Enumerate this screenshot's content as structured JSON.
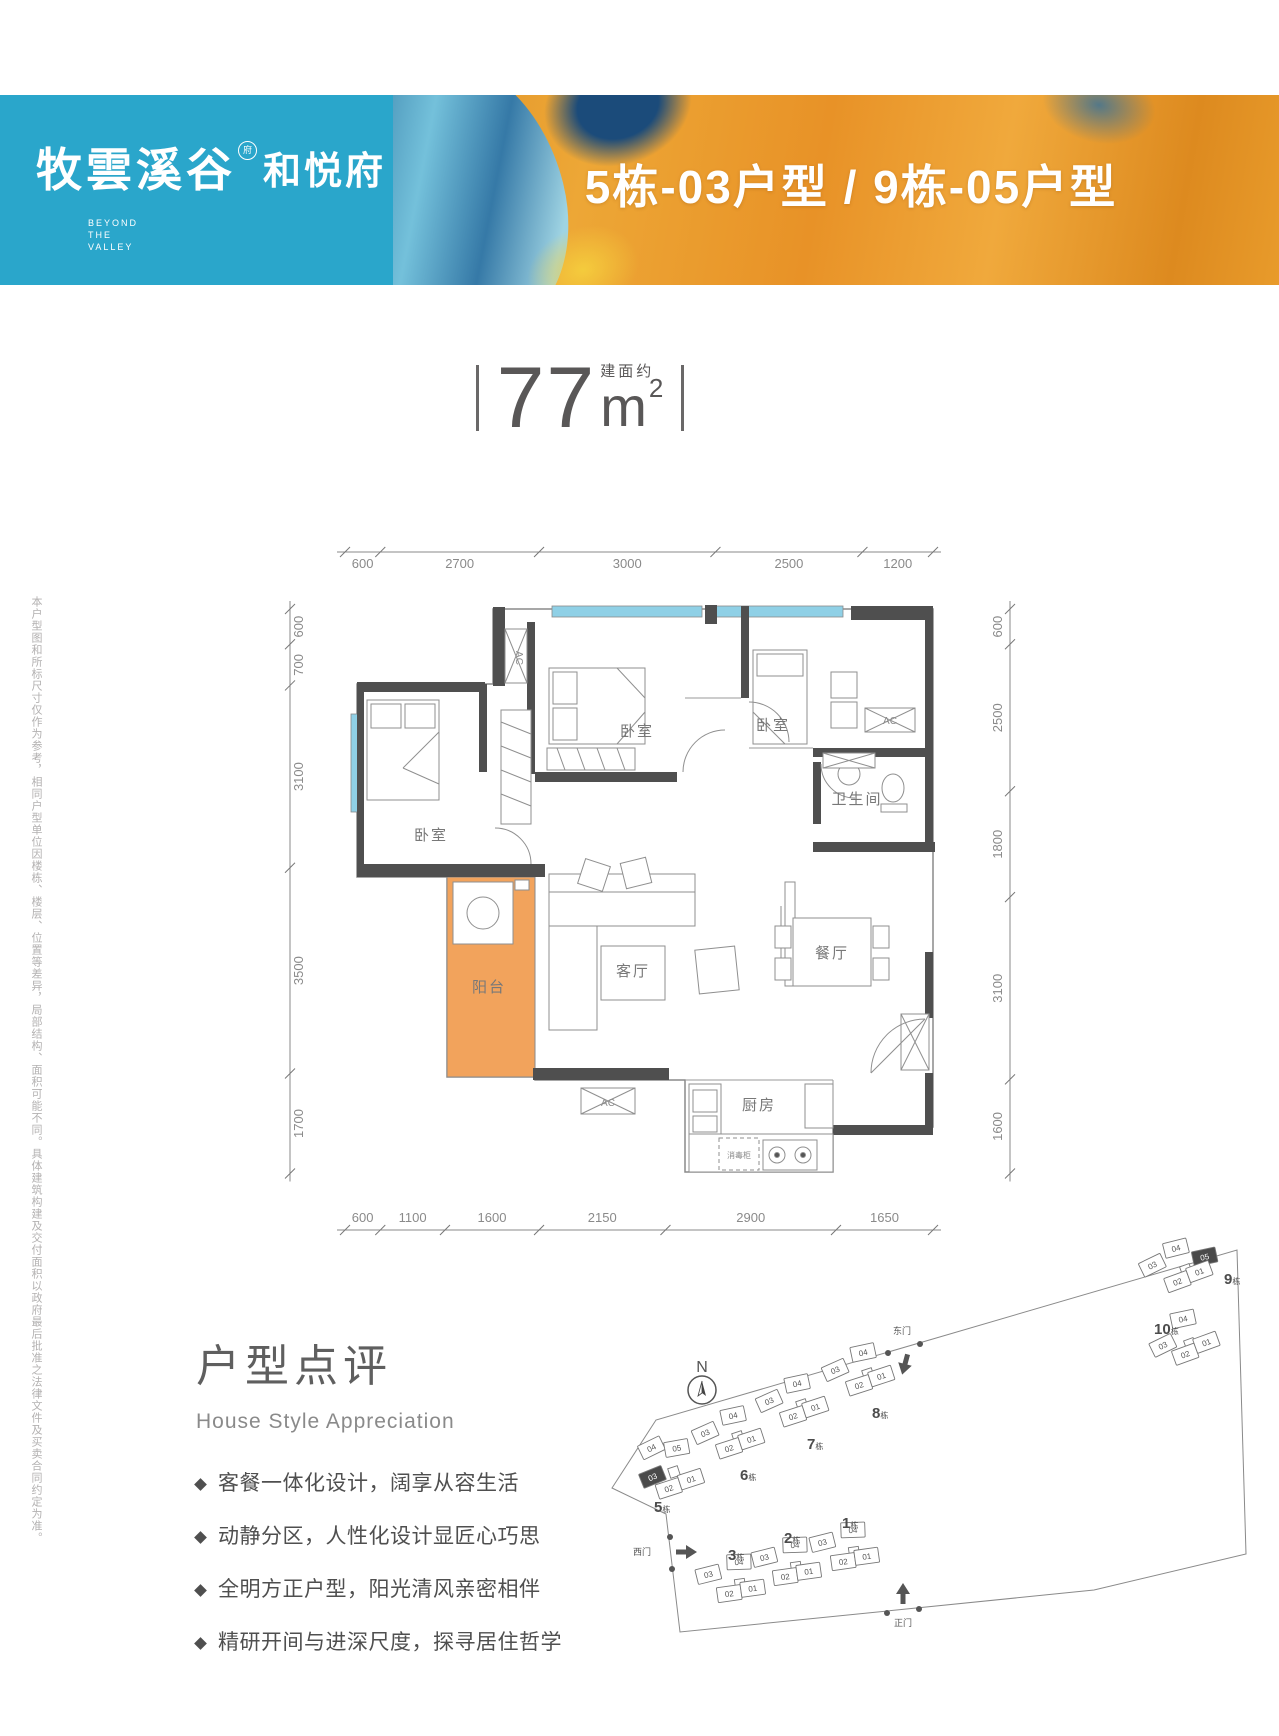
{
  "colors": {
    "brand_teal": "#2aa6cb",
    "paint_orange": "#e89227",
    "paint_blue": "#2c77ad",
    "wall_gray": "#4f4f4f",
    "window_blue": "#8fd0e6",
    "balcony_orange": "#f2a35c",
    "text_gray": "#595757"
  },
  "header": {
    "logo_cn": "牧雲溪谷",
    "logo_mark": "府",
    "logo_sub": "和悦府",
    "logo_en": [
      "BEYOND",
      "THE",
      "VALLEY"
    ],
    "title": "5栋-03户型 / 9栋-05户型"
  },
  "area": {
    "prefix": "建面约",
    "value": "77",
    "unit": "m",
    "exp": "2"
  },
  "floorplan": {
    "dims": {
      "top": [
        "600",
        "2700",
        "3000",
        "2500",
        "1200"
      ],
      "bottom": [
        "600",
        "1100",
        "1600",
        "2150",
        "2900",
        "1650"
      ],
      "left": [
        "600",
        "700",
        "3100",
        "3500",
        "1700"
      ],
      "right": [
        "600",
        "2500",
        "1800",
        "3100",
        "1600"
      ]
    },
    "rooms": [
      "卧室",
      "卧室",
      "卧室",
      "卫生间",
      "客厅",
      "餐厅",
      "阳台",
      "厨房"
    ],
    "ac_label": "AC",
    "sterilizer_label": "消毒柜"
  },
  "disclaimer": "本户型图和所标尺寸仅作为参考，相同户型单位因楼栋、楼层、位置等差异，局部结构、面积可能不同。具体建筑构建及交付面积以政府最后批准之法律文件及买卖合同约定为准。",
  "review": {
    "title_cn": "户型点评",
    "title_en": "House Style Appreciation",
    "bullets": [
      "客餐一体化设计，阔享从容生活",
      "动静分区，人性化设计显匠心巧思",
      "全明方正户型，阳光清风亲密相伴",
      "精研开间与进深尺度，探寻居住哲学"
    ]
  },
  "sitemap": {
    "compass": "N",
    "buildings": [
      {
        "num": "5",
        "suffix": "栋",
        "units": [
          {
            "label": "04"
          },
          {
            "label": "05"
          },
          {
            "label": "03",
            "highlight": true
          },
          {
            "label": "02"
          },
          {
            "label": "01"
          }
        ]
      },
      {
        "num": "6",
        "suffix": "栋",
        "units": [
          {
            "label": "03"
          },
          {
            "label": "04"
          },
          {
            "label": "02"
          },
          {
            "label": "01"
          }
        ]
      },
      {
        "num": "7",
        "suffix": "栋",
        "units": [
          {
            "label": "03"
          },
          {
            "label": "04"
          },
          {
            "label": "02"
          },
          {
            "label": "01"
          }
        ]
      },
      {
        "num": "8",
        "suffix": "栋",
        "units": [
          {
            "label": "03"
          },
          {
            "label": "04"
          },
          {
            "label": "02"
          },
          {
            "label": "01"
          }
        ]
      },
      {
        "num": "9",
        "suffix": "栋",
        "units": [
          {
            "label": "03"
          },
          {
            "label": "04"
          },
          {
            "label": "05",
            "highlight": true
          },
          {
            "label": "02"
          },
          {
            "label": "01"
          }
        ]
      },
      {
        "num": "10",
        "suffix": "栋",
        "units": [
          {
            "label": "04"
          },
          {
            "label": "03"
          },
          {
            "label": "02"
          },
          {
            "label": "01"
          }
        ]
      },
      {
        "num": "1",
        "suffix": "栋",
        "units": [
          {
            "label": "03"
          },
          {
            "label": "04"
          },
          {
            "label": "02"
          },
          {
            "label": "01"
          }
        ]
      },
      {
        "num": "2",
        "suffix": "栋",
        "units": [
          {
            "label": "03"
          },
          {
            "label": "04"
          },
          {
            "label": "02"
          },
          {
            "label": "01"
          }
        ]
      },
      {
        "num": "3",
        "suffix": "栋",
        "units": [
          {
            "label": "03"
          },
          {
            "label": "04"
          },
          {
            "label": "02"
          },
          {
            "label": "01"
          }
        ]
      }
    ],
    "gates": [
      {
        "label": "东门"
      },
      {
        "label": "西门"
      },
      {
        "label": "正门"
      }
    ]
  }
}
